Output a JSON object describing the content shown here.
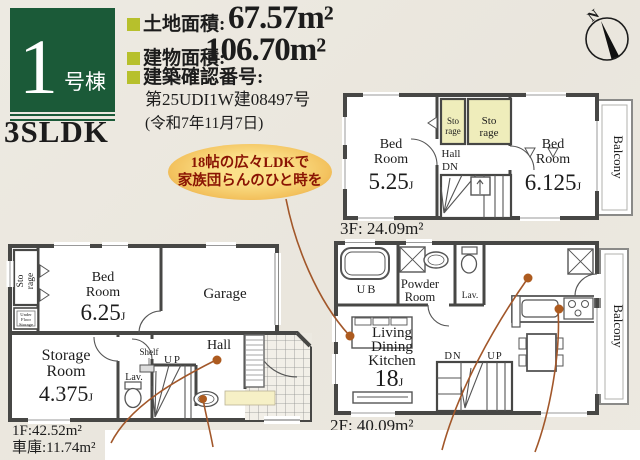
{
  "header": {
    "unit_number": "1",
    "unit_label": "号棟",
    "plan_type": "3SLDK",
    "land_label": "土地面積:",
    "land_value": "67.57m²",
    "building_label": "建物面積:",
    "building_value": "106.70m²",
    "confirmation_label": "建築確認番号:",
    "confirmation_number": "第25UDI1W建08497号",
    "confirmation_date": "(令和7年11月7日)"
  },
  "compass": {
    "north": "N"
  },
  "callout": {
    "line1": "18帖の広々LDKで",
    "line2": "家族団らんのひと時を"
  },
  "floor3": {
    "bedroom_left_name1": "Bed",
    "bedroom_left_name2": "Room",
    "bedroom_left_size": "5.25",
    "bedroom_left_unit": "J",
    "bedroom_right_name1": "Bed",
    "bedroom_right_name2": "Room",
    "bedroom_right_size": "6.125",
    "bedroom_right_unit": "J",
    "storage1_line1": "Sto",
    "storage1_line2": "rage",
    "storage2_line1": "Sto",
    "storage2_line2": "rage",
    "hall": "Hall",
    "down": "DN",
    "balcony": "Balcony",
    "area_label": "3F: 24.09m²"
  },
  "floor1": {
    "storage_side_line1": "Sto",
    "storage_side_line2": "rage",
    "underfloor_line1": "Under",
    "underfloor_line2": "Floor",
    "underfloor_line3": "Storage",
    "bedroom_name1": "Bed",
    "bedroom_name2": "Room",
    "bedroom_size": "6.25",
    "bedroom_unit": "J",
    "garage": "Garage",
    "storage_room_name1": "Storage",
    "storage_room_name2": "Room",
    "storage_room_size": "4.375",
    "storage_room_unit": "J",
    "lavatory": "Lav.",
    "shelf": "Shelf",
    "up": "UP",
    "hall": "Hall",
    "area_label": "1F:42.52m²",
    "garage_area_label": "車庫:11.74m²"
  },
  "floor2": {
    "unit_bath": "UB",
    "powder_line1": "Powder",
    "powder_line2": "Room",
    "lavatory": "Lav.",
    "ldk_line1": "Living",
    "ldk_line2": "Dining",
    "ldk_line3": "Kitchen",
    "ldk_size": "18",
    "ldk_unit": "J",
    "down": "DN",
    "up": "UP",
    "balcony": "Balcony",
    "area_label": "2F: 40.09m²"
  },
  "colors": {
    "brand_green": "#1b5a38",
    "bullet_yellow": "#b7c02c",
    "callout_text_red": "#8a1403",
    "leader_brown": "#a2572a",
    "storage_highlight": "#efedbb",
    "entry_mat_yellow": "#f6f0c6"
  }
}
